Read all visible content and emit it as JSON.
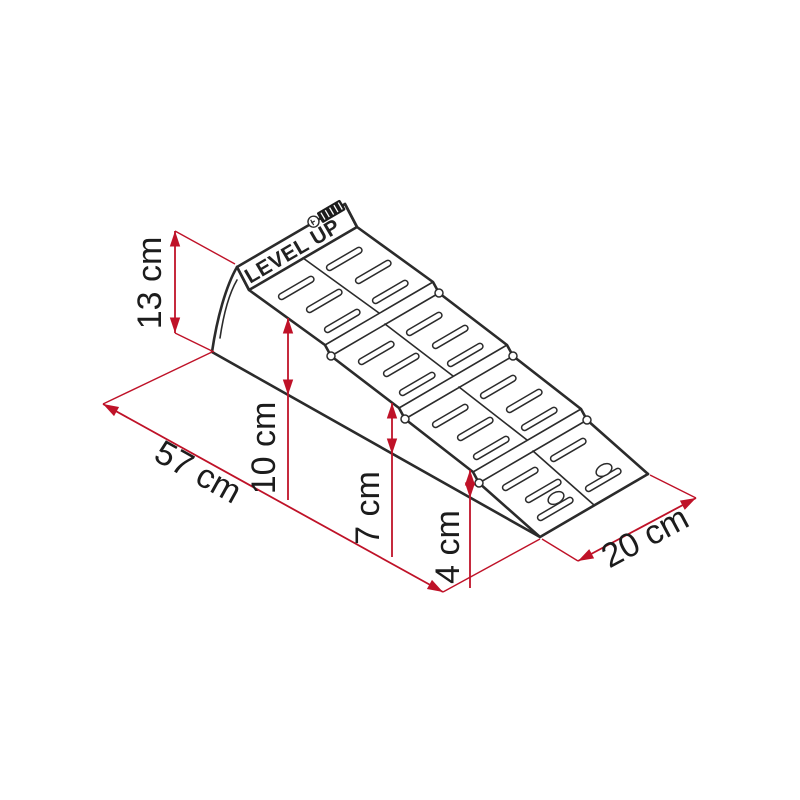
{
  "diagram": {
    "type": "isometric-dimension-drawing",
    "product_label": "LEVEL UP",
    "logo_icon": "fiamma-logo",
    "dimensions": {
      "height_max": "13 cm",
      "length": "57 cm",
      "step_high": "10 cm",
      "step_mid": "7 cm",
      "step_low": "4 cm",
      "width": "20 cm"
    },
    "colors": {
      "dimension_red": "#bf1228",
      "line_black": "#2b2b2b",
      "background": "#ffffff"
    }
  }
}
